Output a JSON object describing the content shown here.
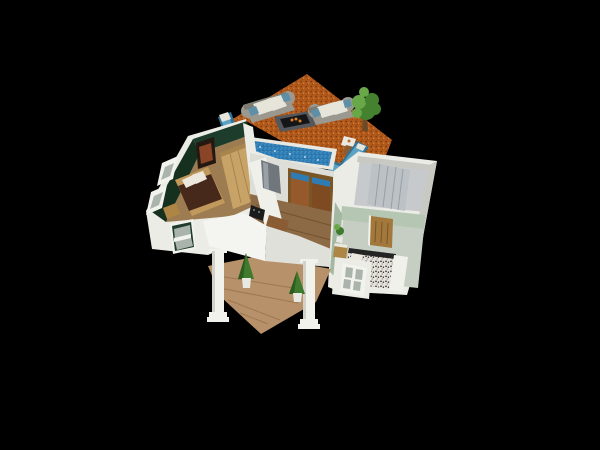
{
  "scene": {
    "type": "3d-home-floorplan-render",
    "camera": "aerial-oblique",
    "areas": [
      {
        "id": "deck",
        "label": "outdoor deck"
      },
      {
        "id": "pool",
        "label": "lap pool"
      },
      {
        "id": "bedroom-green",
        "label": "green bedroom"
      },
      {
        "id": "kitchen-living",
        "label": "kitchen and living room"
      },
      {
        "id": "closet",
        "label": "closet room"
      },
      {
        "id": "bedroom-sage",
        "label": "sage bedroom bath"
      },
      {
        "id": "porch",
        "label": "front porch"
      }
    ],
    "furniture": [
      "outdoor sofa left",
      "outdoor sofa right",
      "fire pit table",
      "chaise lounge left",
      "chaise lounge right 1",
      "chaise lounge right 2",
      "potted tree",
      "deck side table",
      "bed",
      "wardrobe",
      "wall picture",
      "refrigerator",
      "kitchen counter",
      "cooktop",
      "coffee table",
      "sliding glass door",
      "closet panels",
      "wooden door",
      "speckled bed",
      "white bed frame",
      "nightstand",
      "small plant",
      "porch column left",
      "porch column right",
      "potted cypress left",
      "potted cypress right"
    ]
  },
  "colors": {
    "background": "#000000",
    "deck": "#b2591c",
    "deck_speck_dark": "#7d3c10",
    "deck_speck_light": "#d98334",
    "pool_coping": "#e8e7e0",
    "pool_water": "#2e7cb3",
    "pool_speck": "#6fb9df",
    "pool_speck_dark": "#1d567f",
    "pool_sparkle": "#e8f4fa",
    "wall_white": "#ecece7",
    "wall_face": "#deded8",
    "wall_shade": "#c9c9c3",
    "green_wall": "#1e3c2b",
    "green_wall_dark": "#16301f",
    "green_floor": "#9c7c50",
    "sage_wall": "#b5c6b3",
    "sage_wall_dark": "#a3b8a1",
    "sage_floor": "#c6cec3",
    "wood_floor": "#8c6a45",
    "wood_line": "#73532f",
    "porch_floor": "#b7916a",
    "porch_line": "#9c7850",
    "wardrobe_wood": "#c8a368",
    "wardrobe_side": "#a8854c",
    "bed_frame": "#c2995c",
    "bed_blanket": "#46291b",
    "pillow": "#ece8dd",
    "picture_frame": "#241810",
    "picture_art": "#8a4526",
    "window_frame": "#f3f3ee",
    "window_pane": "#aab4ac",
    "counter": "#f0f0ea",
    "fridge": "#70767b",
    "fridge_light": "#9aa1a6",
    "cooktop": "#1b1b1b",
    "table_wood": "#8a5c33",
    "orange_item": "#c76a1e",
    "closet_floor": "#c7cacc",
    "closet_panels": "#bcc1c6",
    "closet_seam": "#979ea5",
    "door_wood": "#a2783c",
    "door_line": "#7a5526",
    "glass_warm": "#96592b",
    "glass_warm2": "#7e4a22",
    "terrazzo_base": "#e4e2da",
    "terrazzo_speck": "#242424",
    "terrazzo_speck2": "#8a8a84",
    "tub_white": "#f1f1ec",
    "nightstand": "#ad8545",
    "plant_green": "#3f7a2e",
    "plant_dark": "#2d5c20",
    "foliage": "#44822f",
    "foliage_light": "#69a848",
    "trunk": "#6b4a28",
    "pot_white": "#e9e9e3",
    "sofa_gray": "#9b998f",
    "sofa_gray_dark": "#7e7c72",
    "cushion": "#e7e4da",
    "accent_blue": "#5d8fa9",
    "chaise_blue": "#2f7396",
    "chaise_blue_light": "#5ba3c4",
    "firepit_body": "#54585d",
    "firepit_top": "#141518",
    "flame": "#e07f1f",
    "roof_white": "#f4f4f0",
    "roof_shade": "#e0e0da",
    "column_white": "#f2f2ed",
    "column_shade": "#d2d2cb"
  }
}
